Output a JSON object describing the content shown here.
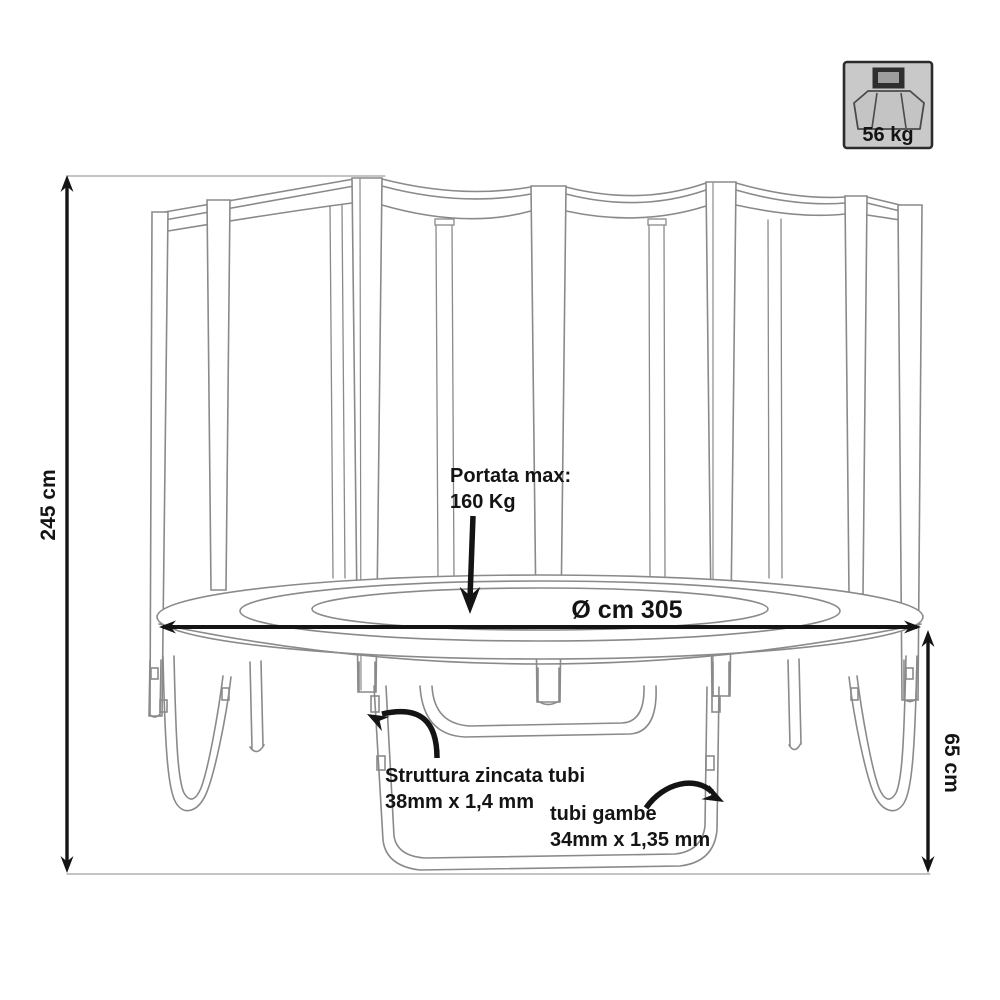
{
  "diagram": {
    "type": "technical-drawing",
    "subject": "Trampoline with safety enclosure net – dimension drawing",
    "colors": {
      "background": "#ffffff",
      "drawing_line": "#8a8a8a",
      "annotation": "#141414",
      "badge_bg": "#c9c9c9",
      "badge_border": "#2b2b2b"
    },
    "dimensions": {
      "height": {
        "label": "245 cm"
      },
      "diameter": {
        "label": "Ø cm 305"
      },
      "leg_height": {
        "label": "65 cm"
      }
    },
    "annotations": {
      "max_load": {
        "line1": "Portata max:",
        "line2": "160 Kg"
      },
      "frame_tubes": {
        "line1": "Struttura zincata tubi",
        "line2": "38mm x 1,4 mm"
      },
      "leg_tubes": {
        "line1": "tubi gambe",
        "line2": "34mm x 1,35 mm"
      }
    },
    "weight_badge": {
      "label": "56 kg",
      "icon": "packed-trampoline-weight-icon"
    }
  }
}
